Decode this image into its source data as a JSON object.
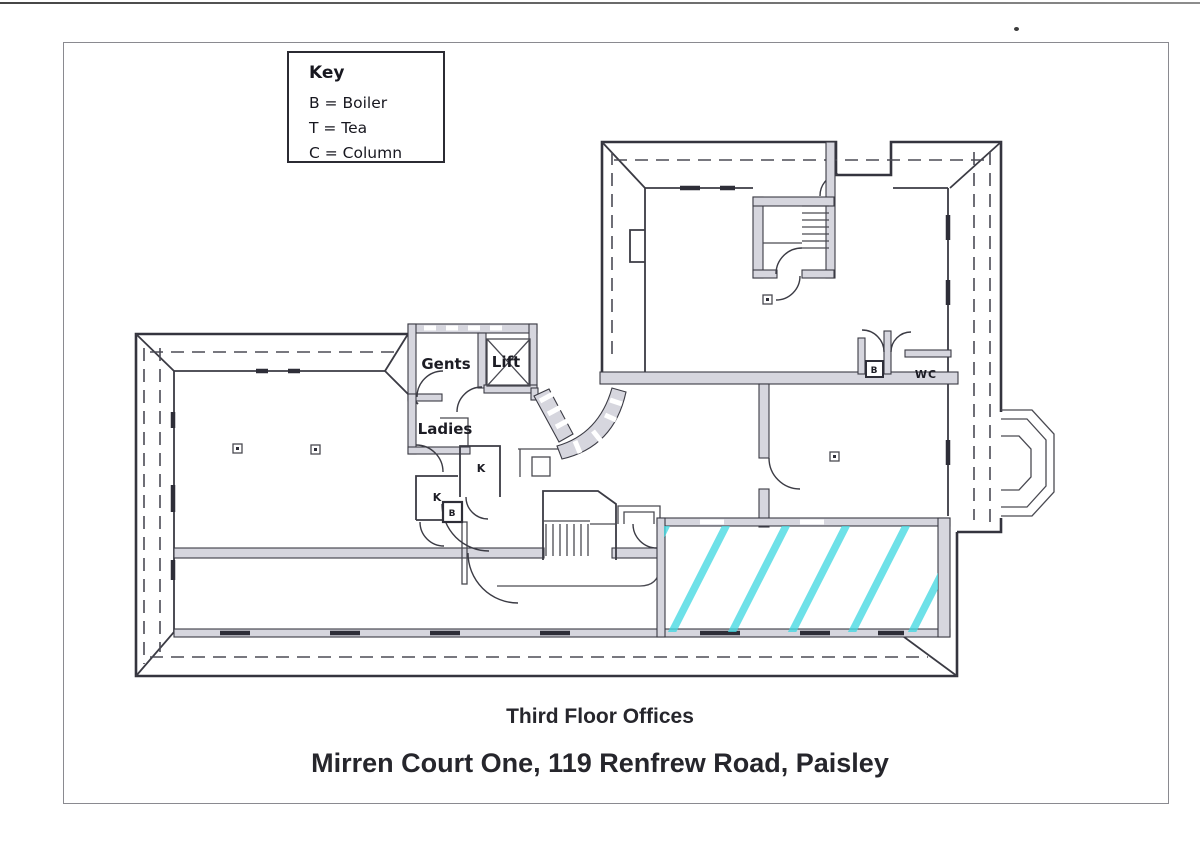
{
  "document": {
    "key": {
      "title": "Key",
      "entries": [
        "B = Boiler",
        "T = Tea",
        "C = Column"
      ]
    },
    "plan_labels": {
      "gents": "Gents",
      "lift": "Lift",
      "ladies": "Ladies",
      "kitchen_a": "K",
      "kitchen_b": "K",
      "boiler_core": "B",
      "boiler_wc": "B",
      "wc": "WC"
    },
    "titles": {
      "floor": "Third Floor Offices",
      "address": "Mirren Court One, 119 Renfrew Road, Paisley"
    },
    "colors": {
      "highlight": "#45d9e2",
      "wall_fill": "#d6d6de",
      "line": "#3b3b44"
    }
  }
}
